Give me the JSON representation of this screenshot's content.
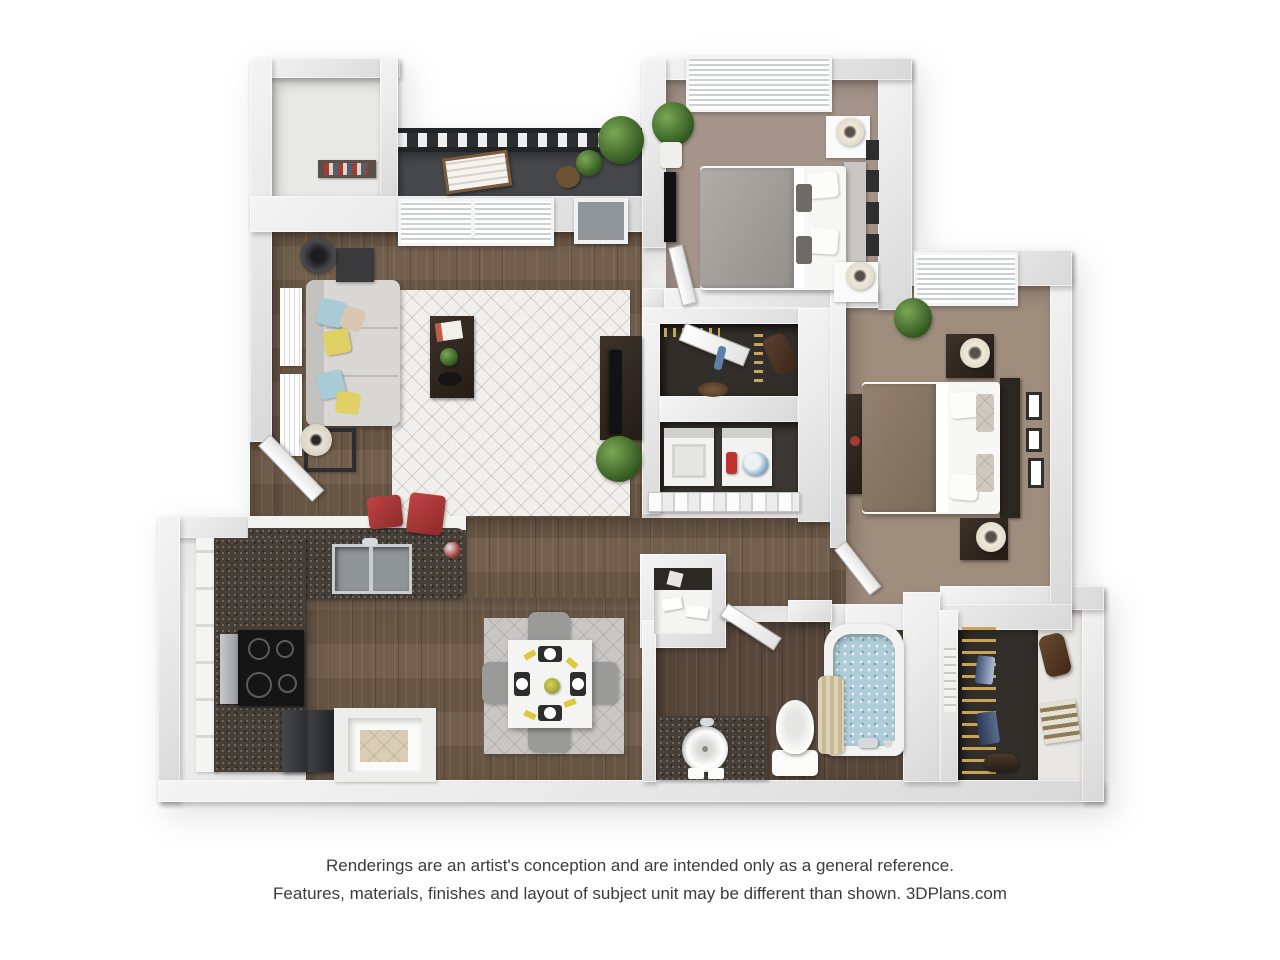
{
  "image_type": "3d-floorplan-rendering",
  "brand": "3DPlans.com",
  "disclaimer": {
    "line1": "Renderings are an artist's conception and are intended only as a general reference.",
    "line2": "Features, materials, finishes and layout of subject unit may be different than shown. 3DPlans.com"
  },
  "unit": {
    "bedrooms": 2,
    "bathrooms": 1,
    "features": [
      "balcony",
      "balcony-storage",
      "walk-in-closet",
      "in-unit-laundry",
      "coat-closet",
      "pantry",
      "breakfast-bar",
      "open-living-dining"
    ]
  },
  "rooms": [
    {
      "name": "balcony-storage"
    },
    {
      "name": "balcony"
    },
    {
      "name": "living-room"
    },
    {
      "name": "bedroom-1"
    },
    {
      "name": "bedroom-2"
    },
    {
      "name": "coat-closet"
    },
    {
      "name": "laundry-closet"
    },
    {
      "name": "kitchen"
    },
    {
      "name": "pantry"
    },
    {
      "name": "dining-area"
    },
    {
      "name": "hallway"
    },
    {
      "name": "bathroom"
    },
    {
      "name": "walk-in-closet"
    },
    {
      "name": "entry"
    }
  ],
  "palette": {
    "background": "#ffffff",
    "wall": "#e6e6e6",
    "wood_floor": "#6d5a48",
    "bathroom_floor": "#57473b",
    "carpet_bedroom1": "#a5948a",
    "carpet_bedroom2": "#9e8c7d",
    "balcony_floor": "#46474b",
    "granite_counter": "#453f38",
    "living_rug": "#f1efec",
    "dining_rug": "#c8c7c4",
    "sofa": "#d6d5d2",
    "pillow_yellow": "#e0d065",
    "pillow_blue": "#a9cbd8",
    "stool_red": "#b23a3a",
    "tub_water": "#aecdd9",
    "plant_green": "#4e7d3a",
    "closet_interior": "#322e29",
    "hanger_gold": "#c9a35a"
  }
}
